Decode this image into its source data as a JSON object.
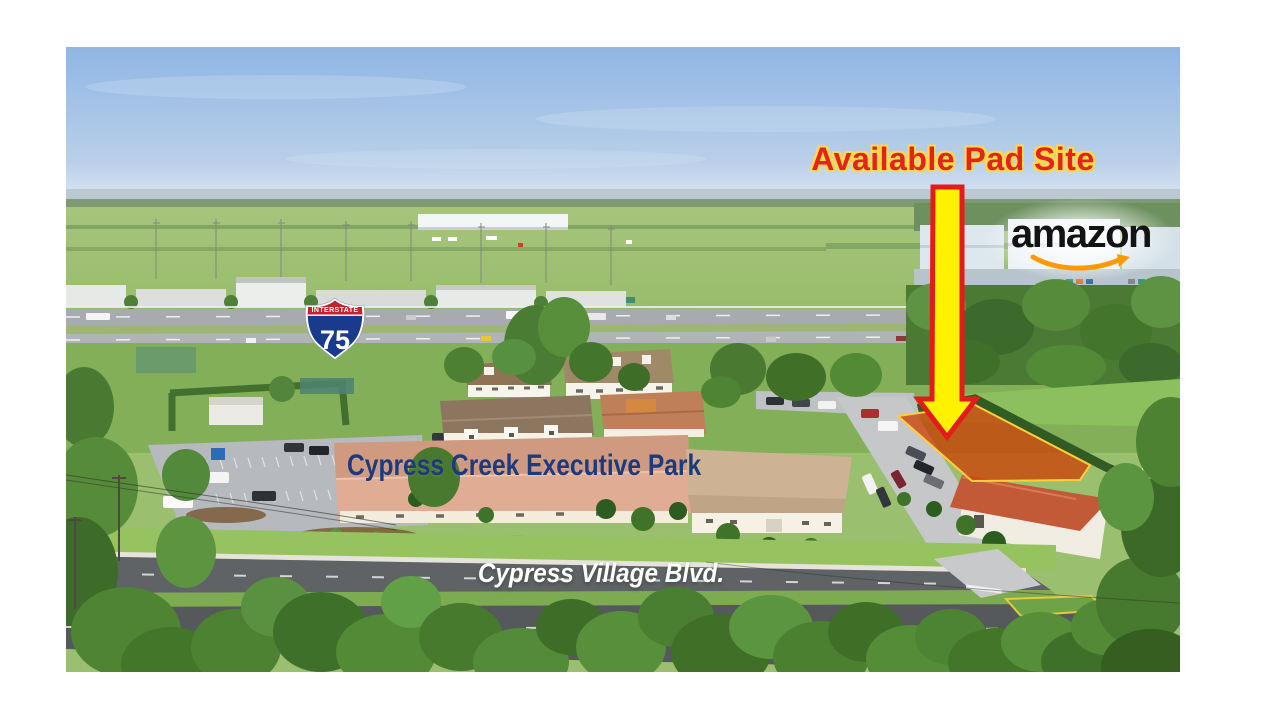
{
  "annotations": {
    "pad_site_label": "Available Pad Site",
    "park_name_label": "Cypress Creek Executive Park",
    "street_name_label": "Cypress Village Blvd."
  },
  "amazon_logo": {
    "wordmark": "amazon"
  },
  "interstate_shield": {
    "header": "INTERSTATE",
    "route_number": "75"
  },
  "icons": {
    "down_arrow_icon": "yellow arrow with red outline pointing down to the pad site",
    "amazon_smile_icon": "orange amazon smile arrow",
    "interstate_75_shield": "red and blue US interstate route shield"
  },
  "colors": {
    "pad_label_text": "#E3241C",
    "pad_label_outline": "#FFD94A",
    "arrow_fill": "#FFF200",
    "arrow_outline": "#E21B1B",
    "pad_overlay_fill": "#CC4208",
    "pad_overlay_outline": "#FFCE3A",
    "park_label_text": "#1E3A7D",
    "street_label_text": "#FFFFFF",
    "amazon_wordmark_text": "#131313",
    "amazon_smile": "#FF9900",
    "shield_red": "#C8202D",
    "shield_blue": "#1A3B8B"
  }
}
